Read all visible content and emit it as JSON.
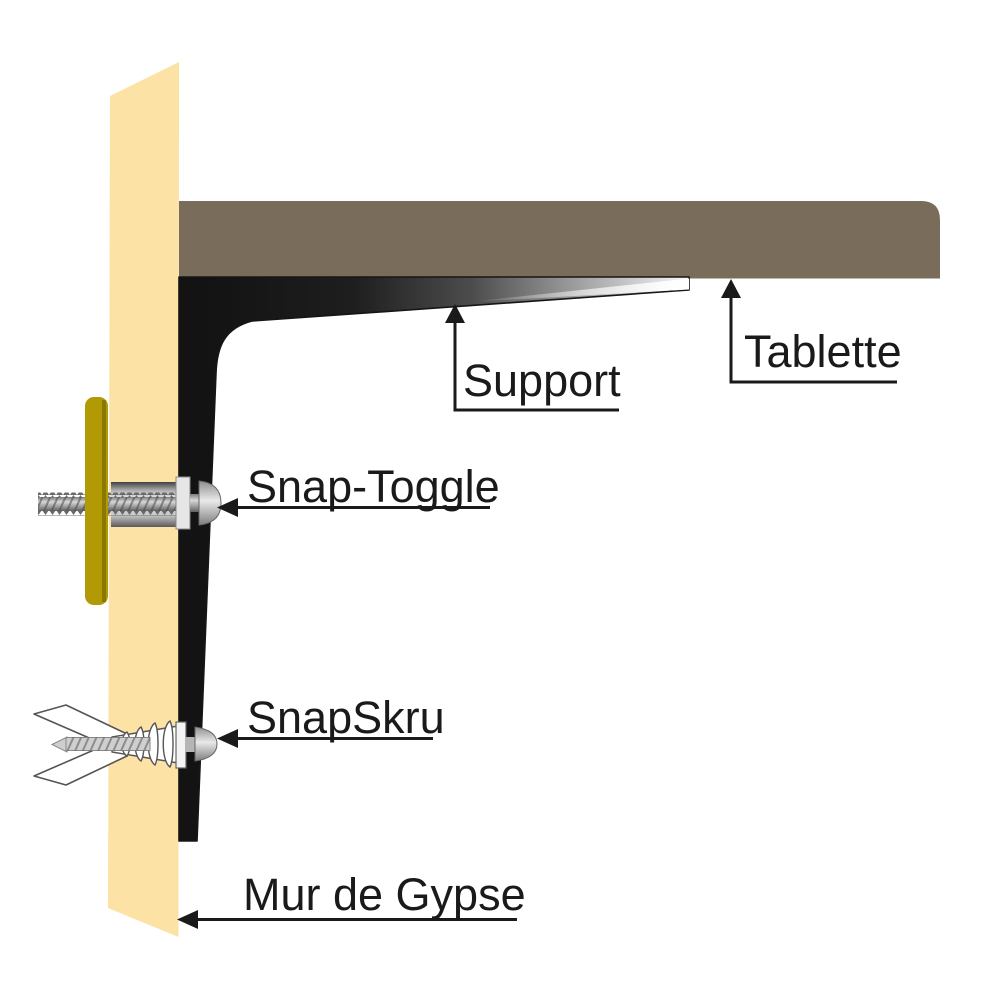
{
  "diagram": {
    "labels": {
      "support": "Support",
      "tablette": "Tablette",
      "snap_toggle": "Snap-Toggle",
      "snapskru": "SnapSkru",
      "wall": "Mur de Gypse"
    },
    "colors": {
      "background": "#FFFFFF",
      "wall": "#FDE2A6",
      "shelf": "#7A6C5A",
      "channel_bar": "#B29A04",
      "bracket_dark": "#161616",
      "callout": "#1A1A1A",
      "hardware_outline": "#555555"
    }
  }
}
